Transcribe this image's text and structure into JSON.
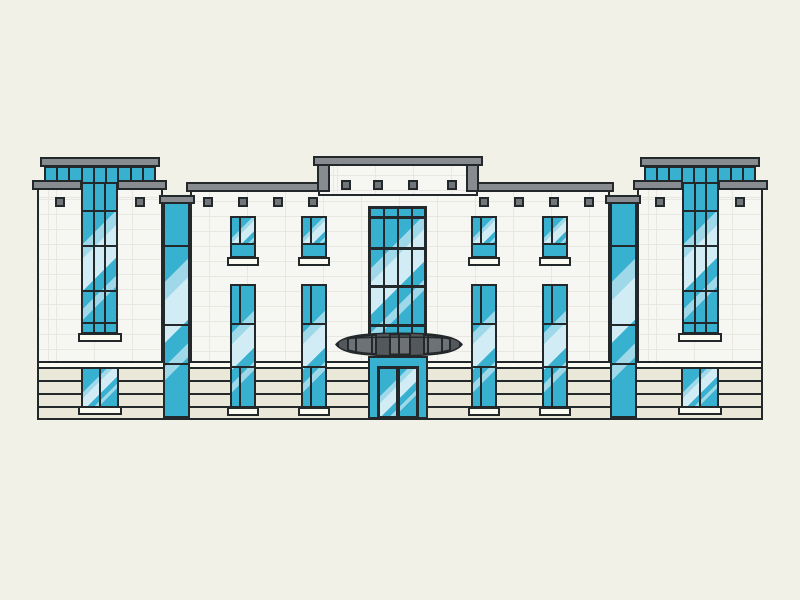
{
  "scene": {
    "description": "Flat vector illustration of a symmetrical modern building facade: two glass-capped towers, a stepped raised central parapet, white brick walls with small gray vent squares, teal glass windows with diagonal reflections, full-height glass strips, a four-column glass curtain wall above a lens-shaped entrance canopy, double glass doors, and horizontal cream ground-floor banding.",
    "style": "flat outline illustration, no text",
    "counts": {
      "towers": 2,
      "tower_clerestory_panes": 9,
      "upper_windows": 4,
      "lower_windows": 4,
      "full_height_glass_strips": 2,
      "tower_glass_strips": 2,
      "ground_floor_windows": 2,
      "parapet_squares": 4,
      "facade_squares": 12,
      "curtain_wall_columns": 4,
      "canopy_count": 1,
      "door_leaves": 2,
      "ground_bands": 4
    }
  },
  "palette": {
    "bg": "#f2f1e7",
    "wall": "#f6f6f2",
    "brick_line": "#e9e8e0",
    "outline": "#23282b",
    "teal": "#38b1d1",
    "glass_light": "#9fd9e9",
    "glass_lighter": "#d2ecf5",
    "cap_gray": "#888c90",
    "canopy_gray": "#6e7276",
    "canopy_gray_dark": "#54585c",
    "square_gray": "#71767a",
    "band_cream": "#e9e8d9",
    "band_white": "#fbfbf2",
    "sill_white": "#fbfbf2"
  }
}
